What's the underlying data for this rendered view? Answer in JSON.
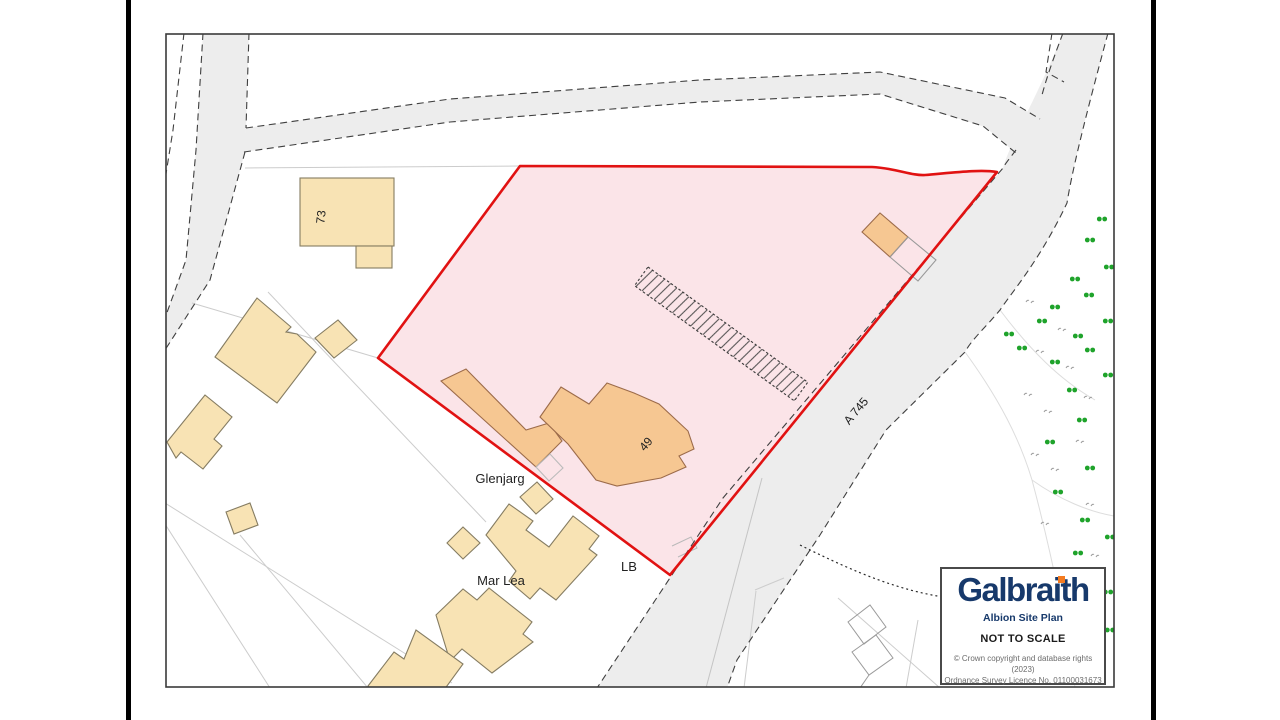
{
  "map_labels": {
    "road_a745": "A 745",
    "building_73": "73",
    "building_49": "49",
    "property_glenjarg": "Glenjarg",
    "property_mar_lea": "Mar Lea",
    "letter_box": "LB"
  },
  "legend": {
    "brand": "Galbraith",
    "plan_title": "Albion Site Plan",
    "scale_note": "NOT TO SCALE",
    "copyright_line1": "© Crown copyright and database rights (2023)",
    "copyright_line2": "Ordnance Survey Licence No. 01100031673"
  },
  "colors": {
    "site_boundary_red": "#e11212",
    "site_fill_pink": "#fbe4e8",
    "building_tan": "#f8e3b4",
    "building_orange": "#f6c792",
    "road_gray": "#ededed",
    "tree_green": "#1fa32b",
    "brand_navy": "#17396b",
    "brand_orange": "#f47b20"
  }
}
